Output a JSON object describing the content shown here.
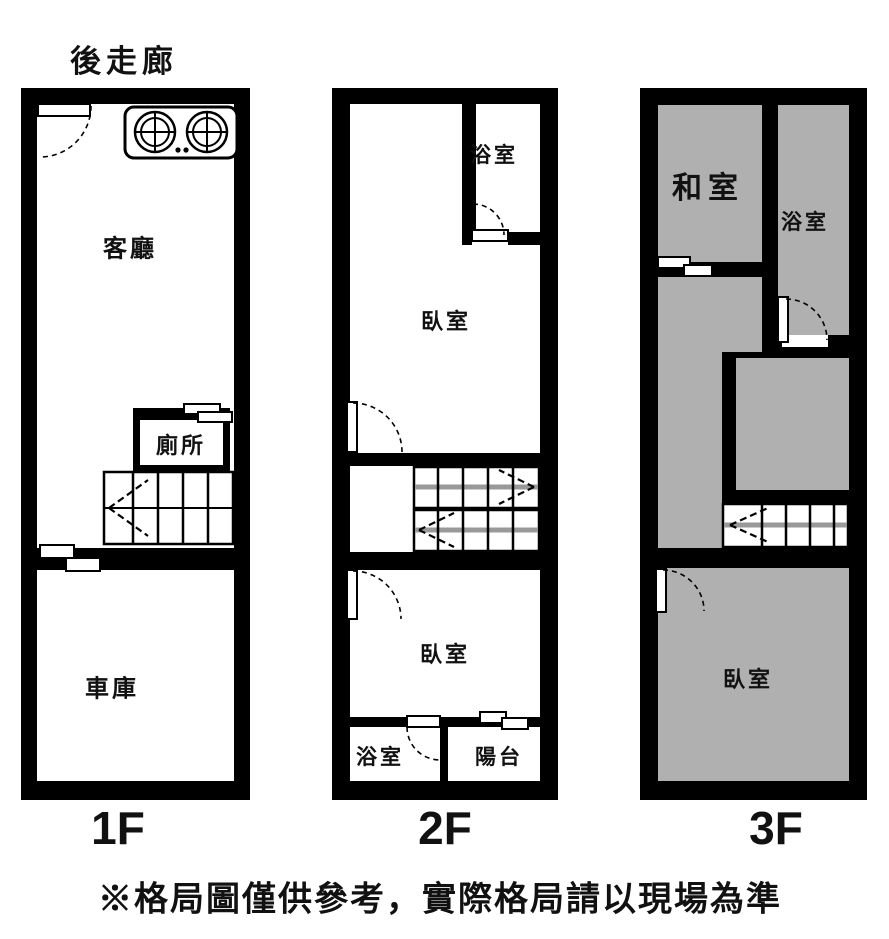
{
  "annotations": {
    "rear_corridor": "後走廊",
    "disclaimer": "※格局圖僅供參考，實際格局請以現場為準"
  },
  "floor_plans": {
    "f1": {
      "floor_label": "1F",
      "living_room": "客廳",
      "toilet": "廁所",
      "garage": "車庫"
    },
    "f2": {
      "floor_label": "2F",
      "bathroom_top": "浴室",
      "bedroom_top": "臥室",
      "bedroom_bottom": "臥室",
      "bathroom_bottom": "浴室",
      "balcony": "陽台"
    },
    "f3": {
      "floor_label": "3F",
      "tatami_room": "和室",
      "bathroom": "浴室",
      "bedroom": "臥室"
    }
  },
  "colors": {
    "wall": "#000000",
    "room": "#ffffff",
    "room_shaded": "#b0b0b0",
    "stair_center_line": "#999999"
  }
}
